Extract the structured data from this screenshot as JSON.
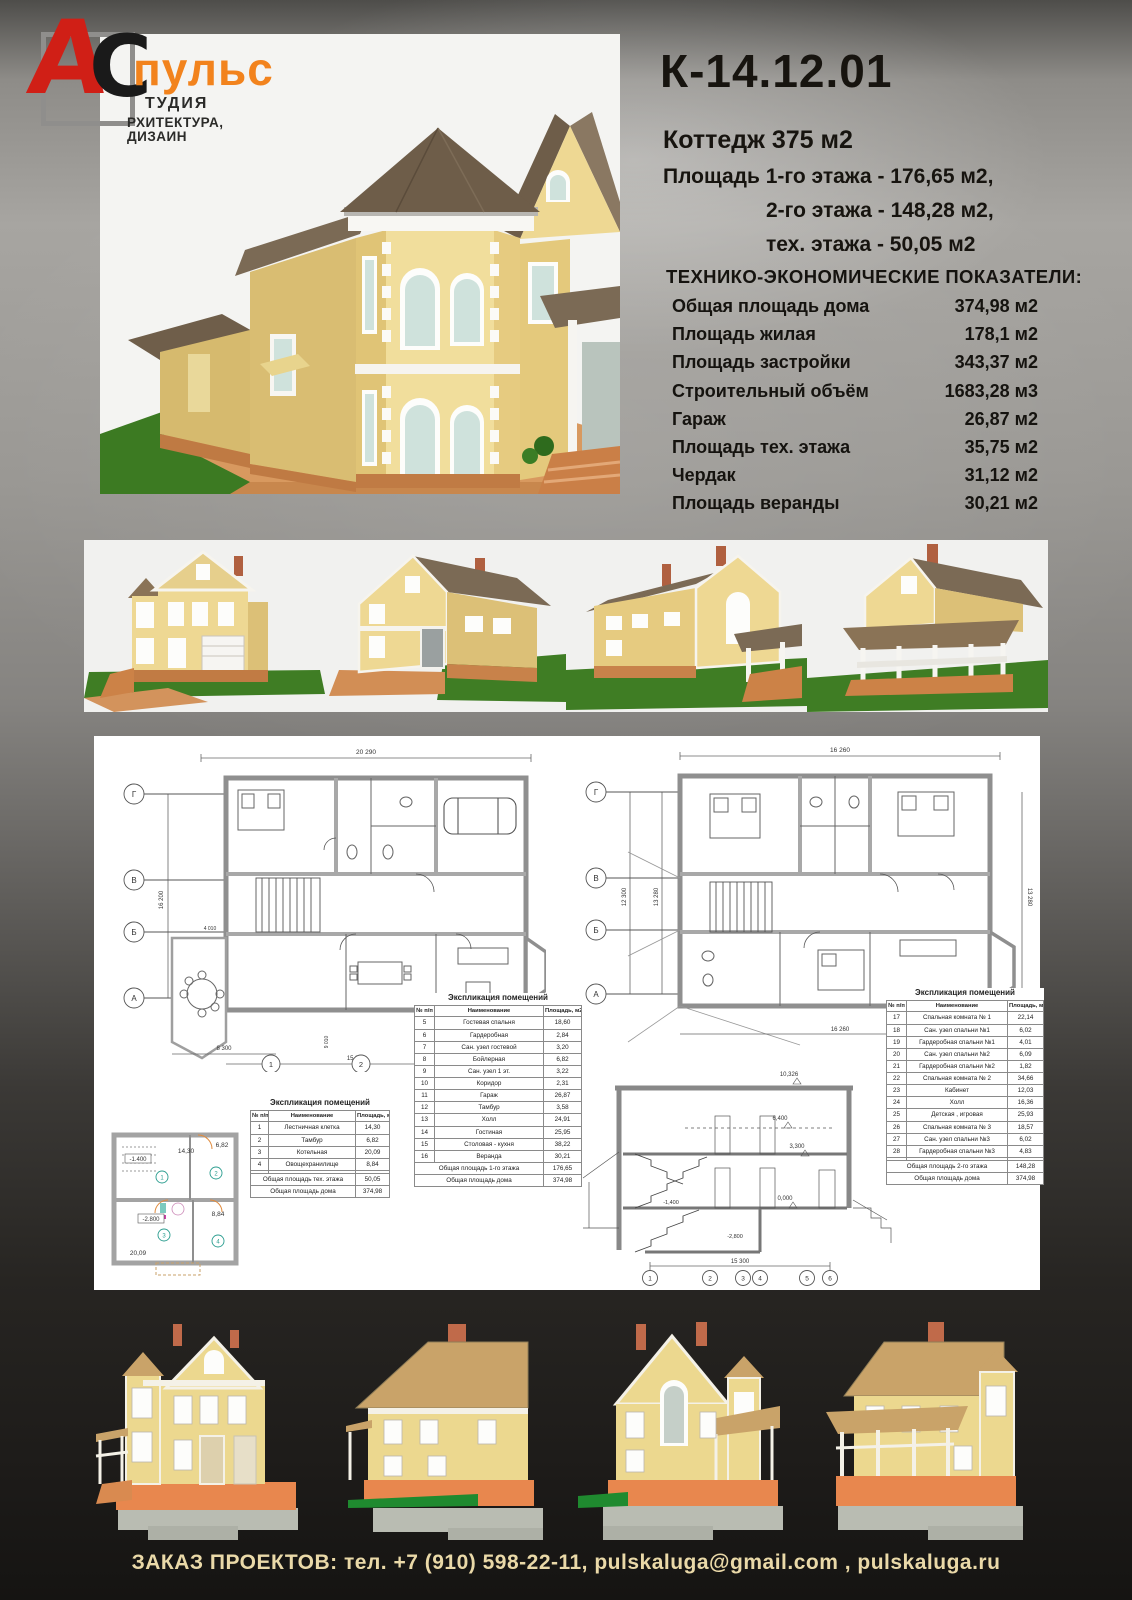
{
  "logo": {
    "letter_a": "А",
    "letter_c": "С",
    "brand": "пульс",
    "studio_line1": "ТУДИЯ",
    "studio_line2": "РХИТЕКТУРА, ДИЗАИН"
  },
  "header": {
    "code": "К-14.12.01",
    "subtitle": "Коттедж 375 м2",
    "area_lines": [
      "Площадь 1-го этажа - 176,65 м2,",
      "2-го этажа - 148,28 м2,",
      "тех. этажа - 50,05 м2"
    ],
    "tep_title": "ТЕХНИКО-ЭКОНОМИЧЕСКИЕ ПОКАЗАТЕЛИ:",
    "tep_rows": [
      [
        "Общая площадь дома",
        "374,98 м2"
      ],
      [
        "Площадь жилая",
        "178,1 м2"
      ],
      [
        "Площадь застройки",
        "343,37 м2"
      ],
      [
        "Строительный объём",
        "1683,28 м3"
      ],
      [
        "Гараж",
        "26,87 м2"
      ],
      [
        "Площадь тех. этажа",
        "35,75 м2"
      ],
      [
        "Чердак",
        "31,12 м2"
      ],
      [
        "Площадь веранды",
        "30,21 м2"
      ]
    ]
  },
  "plans": {
    "expl1": {
      "title": "Экспликация помещений",
      "headers": [
        "№ п/п",
        "Наименование",
        "Площадь, м2"
      ],
      "rows": [
        [
          "5",
          "Гостевая спальня",
          "18,60"
        ],
        [
          "6",
          "Гардеробная",
          "2,84"
        ],
        [
          "7",
          "Сан. узел гостевой",
          "3,20"
        ],
        [
          "8",
          "Бойлерная",
          "6,82"
        ],
        [
          "9",
          "Сан. узел 1 эт.",
          "3,22"
        ],
        [
          "10",
          "Коридор",
          "2,31"
        ],
        [
          "11",
          "Гараж",
          "26,87"
        ],
        [
          "12",
          "Тамбур",
          "3,58"
        ],
        [
          "13",
          "Холл",
          "24,91"
        ],
        [
          "14",
          "Гостиная",
          "25,95"
        ],
        [
          "15",
          "Столовая - кухня",
          "38,22"
        ],
        [
          "16",
          "Веранда",
          "30,21"
        ]
      ],
      "totals": [
        [
          "Общая площадь 1-го этажа",
          "176,65"
        ],
        [
          "Общая площадь дома",
          "374,98"
        ]
      ]
    },
    "expl2": {
      "title": "Экспликация помещений",
      "headers": [
        "№ п/п",
        "Наименование",
        "Площадь, м2"
      ],
      "rows": [
        [
          "17",
          "Спальная комната № 1",
          "22,14"
        ],
        [
          "18",
          "Сан. узел спальни №1",
          "6,02"
        ],
        [
          "19",
          "Гардеробная спальни №1",
          "4,01"
        ],
        [
          "20",
          "Сан. узел спальни №2",
          "6,09"
        ],
        [
          "21",
          "Гардеробная спальни №2",
          "1,82"
        ],
        [
          "22",
          "Спальная комната № 2",
          "34,66"
        ],
        [
          "23",
          "Кабинет",
          "12,03"
        ],
        [
          "24",
          "Холл",
          "16,36"
        ],
        [
          "25",
          "Детская , игровая",
          "25,93"
        ],
        [
          "26",
          "Спальная комната № 3",
          "18,57"
        ],
        [
          "27",
          "Сан. узел спальни №3",
          "6,02"
        ],
        [
          "28",
          "Гардеробная спальни №3",
          "4,83"
        ],
        [
          "",
          "",
          ""
        ]
      ],
      "totals": [
        [
          "Общая площадь 2-го этажа",
          "148,28"
        ],
        [
          "Общая площадь дома",
          "374,98"
        ]
      ]
    },
    "expl3": {
      "title": "Экспликация помещений",
      "headers": [
        "№ п/п",
        "Наименование",
        "Площадь, м2"
      ],
      "rows": [
        [
          "1",
          "Лестничная клетка",
          "14,30"
        ],
        [
          "2",
          "Тамбур",
          "6,82"
        ],
        [
          "3",
          "Котельная",
          "20,09"
        ],
        [
          "4",
          "Овощехранилище",
          "8,84"
        ],
        [
          "",
          "",
          ""
        ]
      ],
      "totals": [
        [
          "Общая площадь тех. этажа",
          "50,05"
        ],
        [
          "Общая площадь дома",
          "374,98"
        ]
      ]
    }
  },
  "drawings": {
    "plan1": {
      "dim_top": "20 290",
      "dim_left": "16 200",
      "dim_b1": "8 300",
      "dim_b2": "15 300",
      "dim_s1": "4 010",
      "dim_s2": "9 010",
      "axes": [
        "Г",
        "В",
        "Б",
        "А"
      ],
      "cols": [
        "1",
        "2",
        "3",
        "4"
      ]
    },
    "plan2": {
      "dim_top": "16 260",
      "dim_bottom": "16 260",
      "dim_left1": "12 300",
      "dim_left2": "13 280",
      "dim_right": "13 280",
      "axes": [
        "Г",
        "В",
        "Б",
        "А"
      ]
    },
    "tech": {
      "level1": "-1.400",
      "level2": "-2.800",
      "area1": "14,30",
      "area2": "6,82",
      "area3": "20,09",
      "area4": "8,84",
      "rooms": [
        "1",
        "2",
        "3",
        "4"
      ]
    },
    "section": {
      "levels": [
        "10,326",
        "6,400",
        "3,300",
        "0,000",
        "-1,400",
        "-2,800"
      ],
      "dim_bottom": "15 300",
      "cols": [
        "1",
        "2",
        "3",
        "4",
        "5",
        "6"
      ]
    }
  },
  "footer": {
    "text": "ЗАКАЗ ПРОЕКТОВ: тел. +7 (910) 598-22-11, pulskaluga@gmail.com , pulskaluga.ru"
  },
  "colors": {
    "logo_red": "#d01f16",
    "accent_orange": "#f2831d",
    "footer_text": "#ead9a8",
    "wall_yellow": "#eed893",
    "roof_brown": "#6e5d49",
    "brick_orange": "#c07b44",
    "lawn_green": "#3c7a22"
  }
}
